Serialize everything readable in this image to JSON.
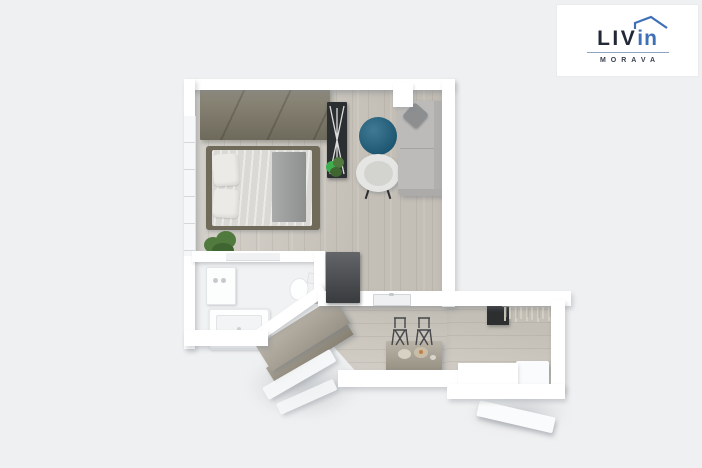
{
  "logo": {
    "brand_main": "LIV",
    "brand_accent": "in",
    "subtitle": "MORAVA",
    "main_color": "#232837",
    "accent_color": "#3f6fb7",
    "divider_color": "#8fa3c4",
    "subtitle_color": "#39404e",
    "card_background": "#ffffff"
  },
  "palette": {
    "background": "#eff0f1",
    "wall": "#ffffff",
    "wood_floor": "#cbc6bd",
    "bathroom_floor": "#f1f2f3",
    "wardrobe": "#7d7868",
    "bed_frame": "#6f6a5a",
    "duvet": "#dfdeda",
    "pillow": "#ebeae6",
    "blanket": "#9a9c9b",
    "rug": "#155d7e",
    "armchair": "#e5e5e3",
    "sofa": "#bcbbb9",
    "sofa_cushion": "#8c8e90",
    "desk": "#2c2f32",
    "plant": "#517a3f",
    "plant_dark": "#3f6631",
    "plant_bright": "#3fae4e",
    "fridge": "#45484b",
    "bar_table": "#aba495",
    "stool": "#45474a",
    "coat_panel": "#2c2e30",
    "hanger": "#d6d1c6",
    "door_beige": "#aaa396",
    "door_beige_side": "#958e7f"
  }
}
